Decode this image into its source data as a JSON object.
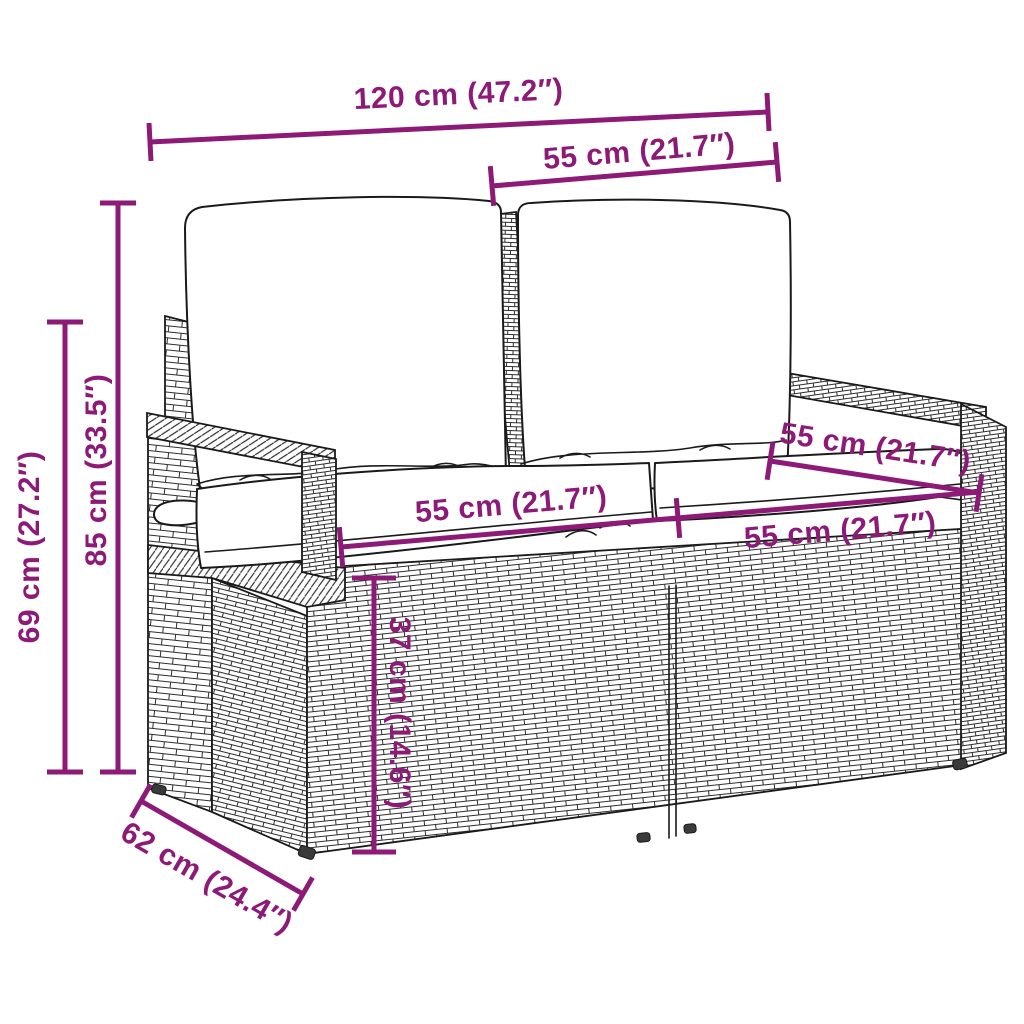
{
  "palette": {
    "dimension_color": "#8E1A78",
    "outline_color": "#1a1a1a",
    "cushion_fill": "#ffffff",
    "background": "#ffffff"
  },
  "illustration": {
    "subject": "poly rattan 2-seater garden sofa with back and seat cushions, line drawing in perspective"
  },
  "dimensions": {
    "overall_width": {
      "label": "120 cm (47.2″)",
      "cm": "120",
      "inches": "47.2"
    },
    "seat_section_top": {
      "label": "55 cm (21.7″)",
      "cm": "55",
      "inches": "21.7"
    },
    "height_total": {
      "label": "85 cm (33.5″)",
      "cm": "85",
      "inches": "33.5"
    },
    "height_armrest": {
      "label": "69 cm (27.2″)",
      "cm": "69",
      "inches": "27.2"
    },
    "seat_depth": {
      "label": "55 cm (21.7″)",
      "cm": "55",
      "inches": "21.7"
    },
    "seat_width_left": {
      "label": "55 cm (21.7″)",
      "cm": "55",
      "inches": "21.7"
    },
    "seat_width_right": {
      "label": "55 cm (21.7″)",
      "cm": "55",
      "inches": "21.7"
    },
    "seat_height": {
      "label": "37 cm (14.6″)",
      "cm": "37",
      "inches": "14.6"
    },
    "depth_total": {
      "label": "62 cm (24.4″)",
      "cm": "62",
      "inches": "24.4"
    }
  }
}
